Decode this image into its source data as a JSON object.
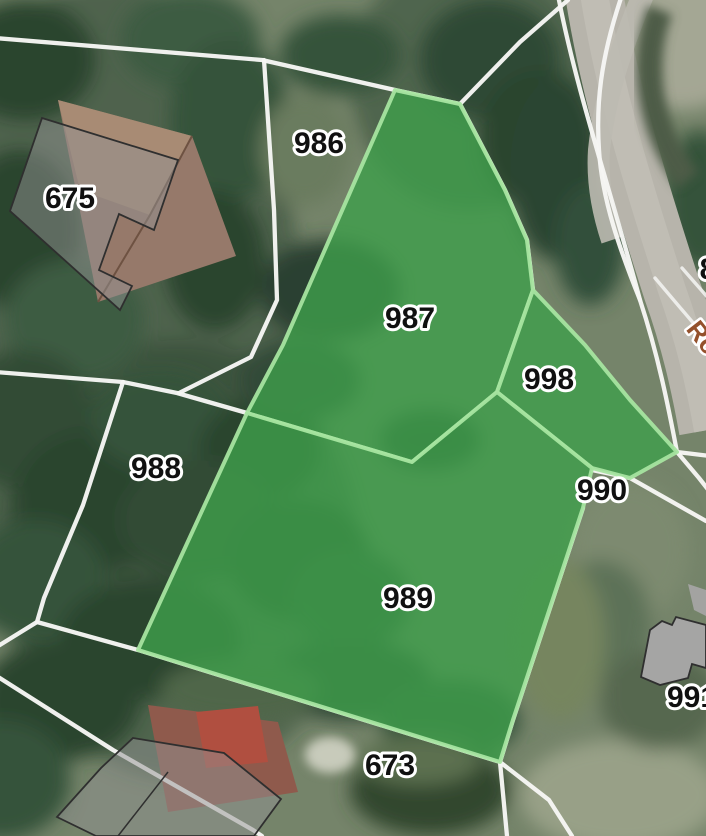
{
  "map": {
    "parcel_labels": [
      {
        "id": "675"
      },
      {
        "id": "986"
      },
      {
        "id": "987"
      },
      {
        "id": "998"
      },
      {
        "id": "988"
      },
      {
        "id": "990"
      },
      {
        "id": "989"
      },
      {
        "id": "673"
      },
      {
        "id": "991"
      },
      {
        "id": "8"
      }
    ],
    "road_label": "Rö",
    "highlighted_parcels": [
      "987",
      "998",
      "989"
    ],
    "colors": {
      "highlight_fill": "#3e9f4b",
      "highlight_border": "#a6e4a0",
      "boundary_line": "#f6f6f4",
      "label_text": "#101010",
      "label_halo": "#ffffff",
      "road_label_color": "#94512c"
    }
  }
}
